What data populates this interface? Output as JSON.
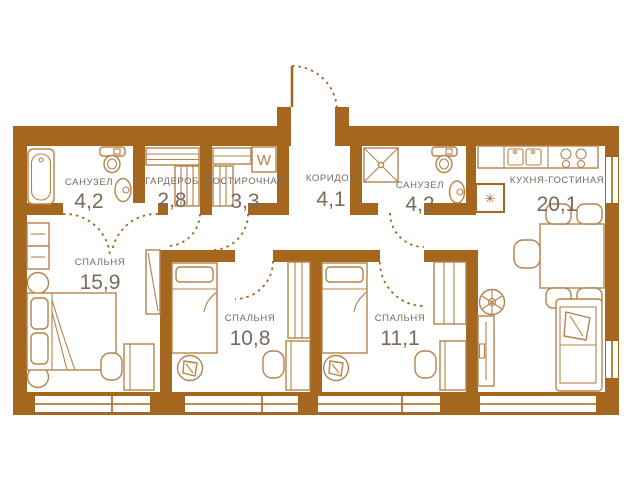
{
  "plan": {
    "type": "apartment-floor-plan",
    "wall_color": "#a5671d",
    "furniture_color": "#b5824a",
    "label_color": "#786a5c",
    "background": "#ffffff",
    "washer_label": "W",
    "shaft_symbol": "✳"
  },
  "rooms": [
    {
      "name": "САНУЗЕЛ",
      "area": "4,2"
    },
    {
      "name": "ГАРДЕРОБ",
      "area": "2,8"
    },
    {
      "name": "ПОСТИРОЧНАЯ",
      "area": "3,3"
    },
    {
      "name": "КОРИДОР",
      "area": "4,1"
    },
    {
      "name": "САНУЗЕЛ",
      "area": "4,2"
    },
    {
      "name": "КУХНЯ-ГОСТИНАЯ",
      "area": "20,1"
    },
    {
      "name": "СПАЛЬНЯ",
      "area": "15,9"
    },
    {
      "name": "СПАЛЬНЯ",
      "area": "10,8"
    },
    {
      "name": "СПАЛЬНЯ",
      "area": "11,1"
    }
  ],
  "furniture_icons": [
    "bathtub",
    "toilet",
    "sink",
    "wardrobe-shelves",
    "storage-rack",
    "washing-machine",
    "shower",
    "kitchen-sink",
    "stove",
    "dining-table",
    "chair",
    "armchair",
    "sofa",
    "tv-console",
    "plant",
    "double-bed",
    "single-bed",
    "desk",
    "desk-chair",
    "nightstand",
    "closet",
    "entry-door",
    "interior-door",
    "window"
  ]
}
